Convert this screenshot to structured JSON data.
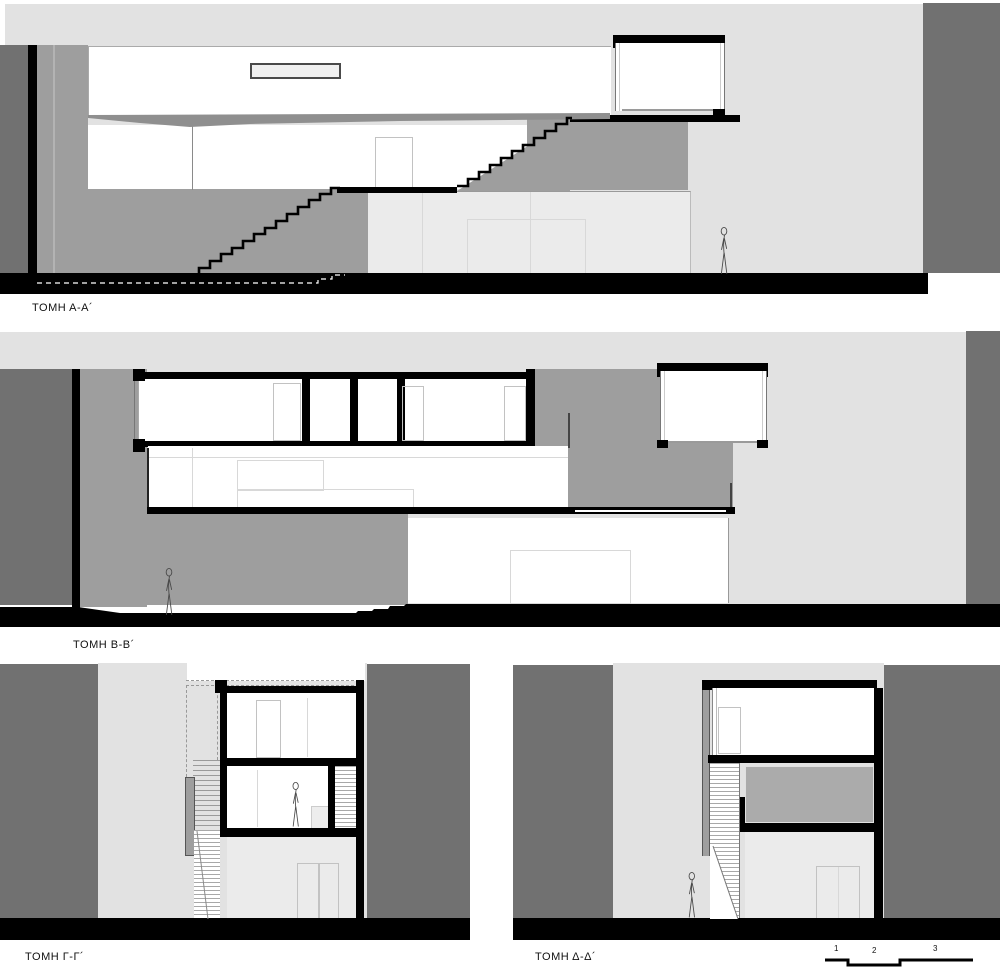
{
  "document": {
    "type": "architectural-section-sheet",
    "language": "Greek"
  },
  "palette": {
    "backdrop": "#e2e2e2",
    "dark_gray": "#717171",
    "mid_gray": "#9e9e9e",
    "ink": "#000000",
    "room_light": "#ebebeb",
    "room_gray": "#ababab",
    "wedge": "#8f8f8f"
  },
  "sections": {
    "a": {
      "label": "ΤΟΜΗ Α-Α´"
    },
    "b": {
      "label": "ΤΟΜΗ Β-Β´"
    },
    "g": {
      "label": "ΤΟΜΗ Γ-Γ´"
    },
    "d": {
      "label": "ΤΟΜΗ Δ-Δ´"
    }
  },
  "scale_bar": {
    "ticks": [
      "1",
      "2",
      "3"
    ]
  }
}
